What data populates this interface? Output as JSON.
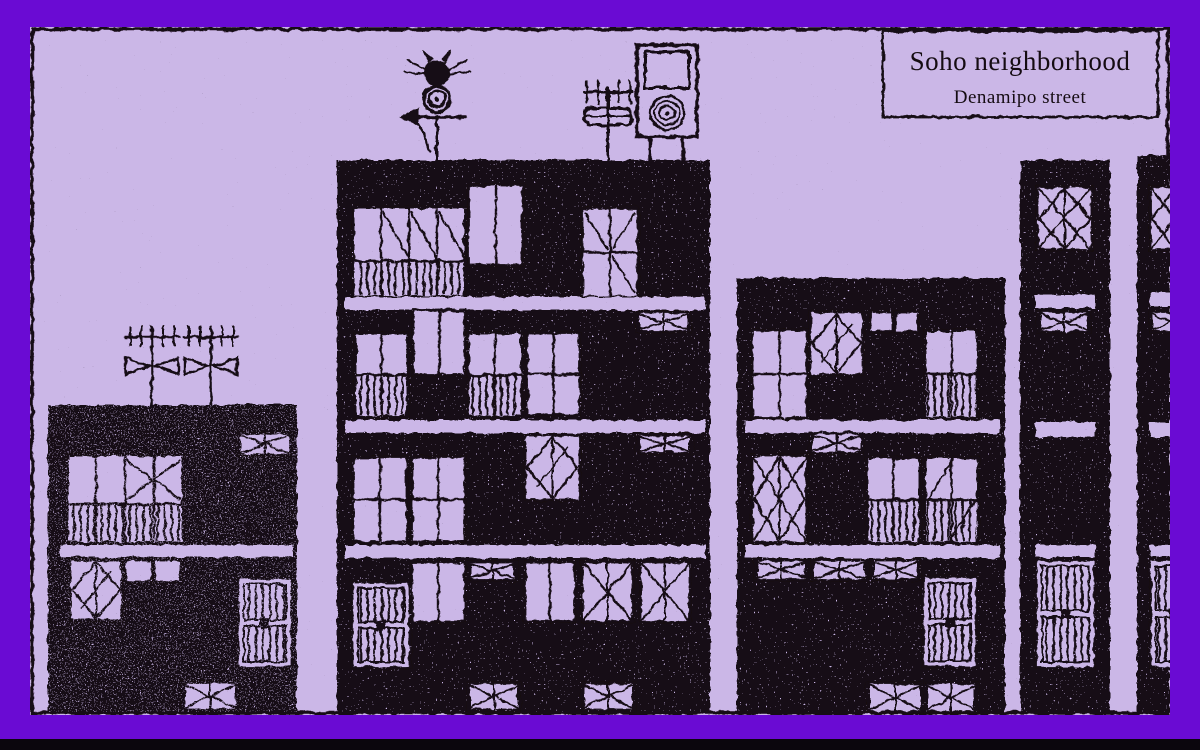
{
  "frame_label": {
    "title": "Soho neighborhood",
    "subtitle": "Denamipo street"
  },
  "colors": {
    "border": "#6A0BD3",
    "background": "#CBB7E7",
    "ink": "#150C12",
    "bottom_bar": "#0B060D"
  },
  "scene": {
    "style": "hand-drawn ink sketch of a street elevation",
    "buildings": [
      {
        "label": "two-story house",
        "roof_items": [
          "tv-antenna",
          "tv-antenna"
        ]
      },
      {
        "label": "four-story apartment",
        "roof_items": [
          "weathervane-spider",
          "tv-antenna",
          "speaker-box"
        ]
      },
      {
        "label": "three-story apartment",
        "roof_items": []
      },
      {
        "label": "narrow tower",
        "roof_items": []
      },
      {
        "label": "narrow tower (cut by frame)",
        "roof_items": []
      }
    ]
  }
}
